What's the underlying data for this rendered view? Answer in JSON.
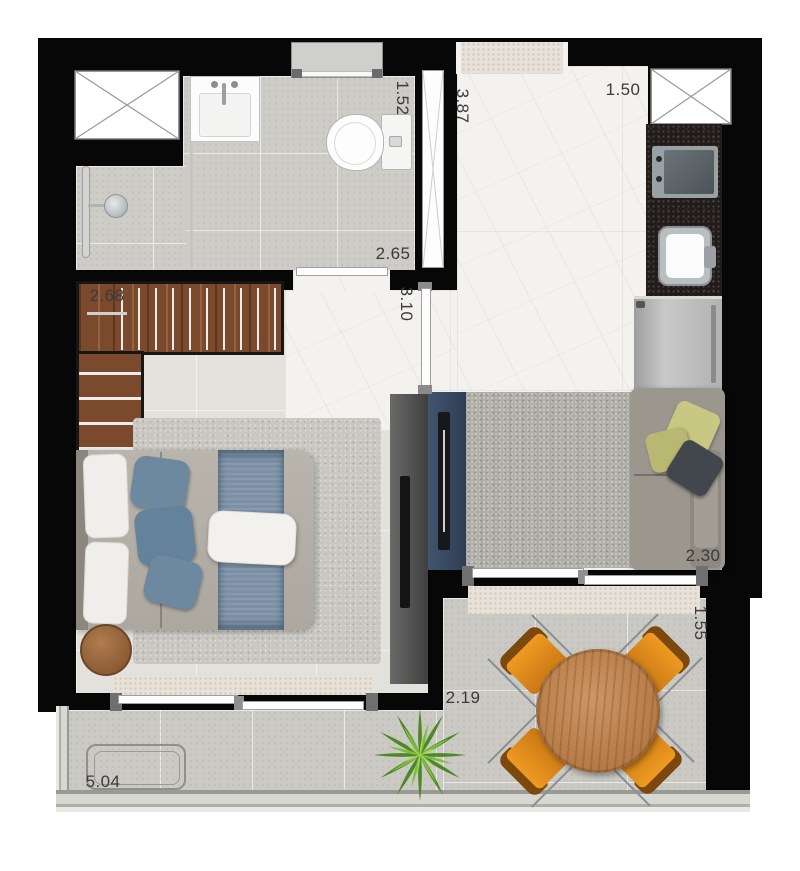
{
  "dimensions": {
    "bathroom_width": "1.52",
    "entry_hall_length": "3.87",
    "kitchen_width": "1.50",
    "bathroom_length": "2.65",
    "hall_length": "3.10",
    "wardrobe_length": "2.68",
    "living_room_width": "2.30",
    "balcony_depth": "1.55",
    "balcony_width": "2.19",
    "terrace_length": "5.04"
  },
  "colors": {
    "walls": "#070707",
    "marble_floor": "#f3f2ef",
    "concrete_floor": "#cdccc7",
    "wardrobe_wood": "#7b4a2c",
    "table_wood": "#c08a57",
    "chair_orange": "#d9831c",
    "bed_blue": "#7b90a5",
    "tv_panel_navy": "#36455d",
    "plant_green": "#7cbe3a",
    "label_text": "#3b3b3b"
  }
}
